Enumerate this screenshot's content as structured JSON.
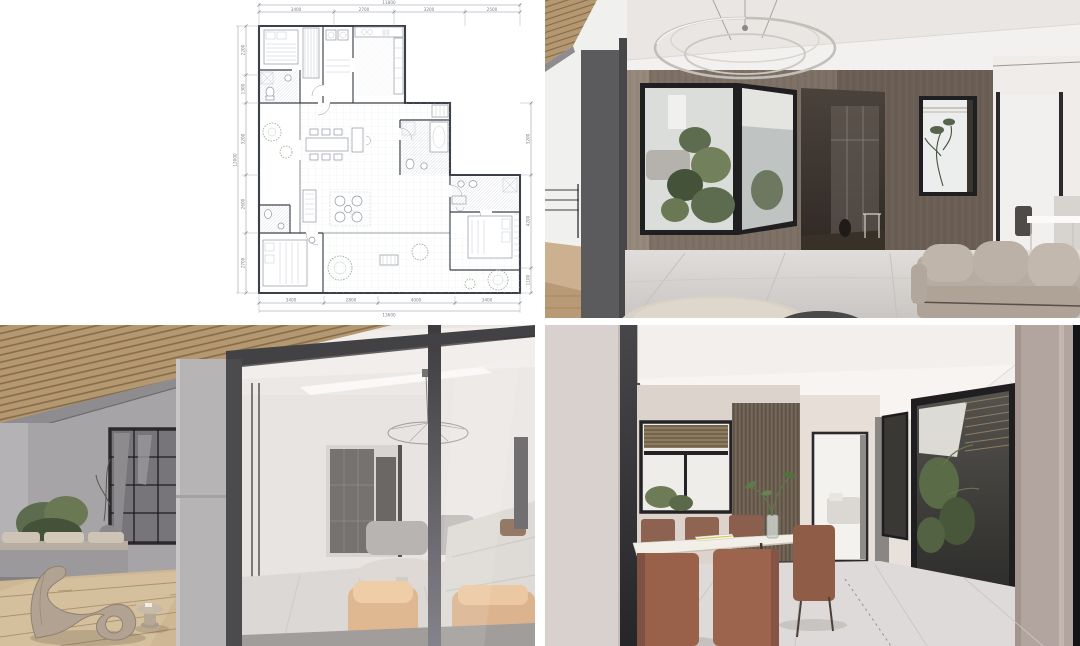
{
  "page": {
    "background": "#ffffff",
    "grid": {
      "gutter_px": 10
    }
  },
  "palette": {
    "plan_wall": "#3c4148",
    "plan_line": "#9096a0",
    "plan_light": "#c3c8d0",
    "plan_text": "#7d838b",
    "plan_green": "#9aa98f",
    "ink_frame": "#1f1e20",
    "wood_wall": "#7d7065",
    "wood_wall_dark": "#6b5f55",
    "wood_wall_light": "#96897b",
    "wood_slat": "#b49872",
    "wood_slat_dark": "#876a46",
    "deck": "#cdb795",
    "deck_gap": "#ab9171",
    "ceiling": "#f3f1ef",
    "wall_warm": "#e8e1db",
    "wall_mauve": "#b2a49e",
    "wall_gray": "#a7a4a7",
    "column_gray": "#b7b4b6",
    "frame_gray": "#4b4a4d",
    "floor_tile": "#d9d6d3",
    "sofa_beige": "#b7aca1",
    "sofa_white": "#d8d4ce",
    "chair_tan": "#d9a878",
    "chair_terracotta": "#99614a",
    "table_white": "#f2efe9",
    "stone_table": "#d8d1c6",
    "dark_table": "#3b3a3c",
    "plant_green": "#5d6b4e",
    "plant_green_dark": "#45523a",
    "blind_wood": "#8d7c5f"
  },
  "floor_plan": {
    "top": {
      "total": "11800",
      "segments": [
        "3400",
        "2700",
        "3200",
        "2500"
      ]
    },
    "bottom": {
      "total": "13600",
      "segments": [
        "3400",
        "2800",
        "4000",
        "3400"
      ]
    },
    "left": {
      "total": "12000",
      "segments": [
        "2200",
        "1300",
        "3200",
        "2600",
        "2700"
      ]
    },
    "right": {
      "segments": [
        "3200",
        "4200",
        "1100"
      ]
    }
  }
}
